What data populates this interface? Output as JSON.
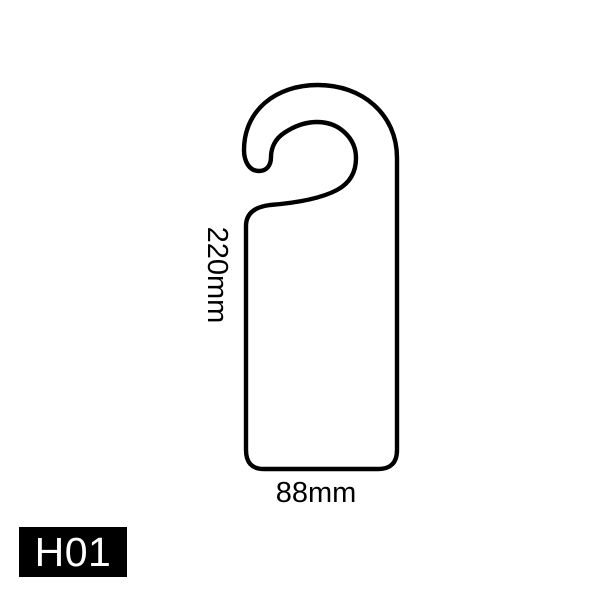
{
  "canvas": {
    "background_color": "#ffffff"
  },
  "diagram": {
    "product": {
      "shape_name": "door-hanger-hook-tag",
      "outline_color": "#000000",
      "fill_color": "#ffffff",
      "stroke_width": "4.4"
    },
    "dimensions": {
      "height_label": "220mm",
      "width_label": "88mm"
    },
    "code_badge": {
      "label": "H01",
      "background": "#000000",
      "text_color": "#ffffff"
    }
  }
}
